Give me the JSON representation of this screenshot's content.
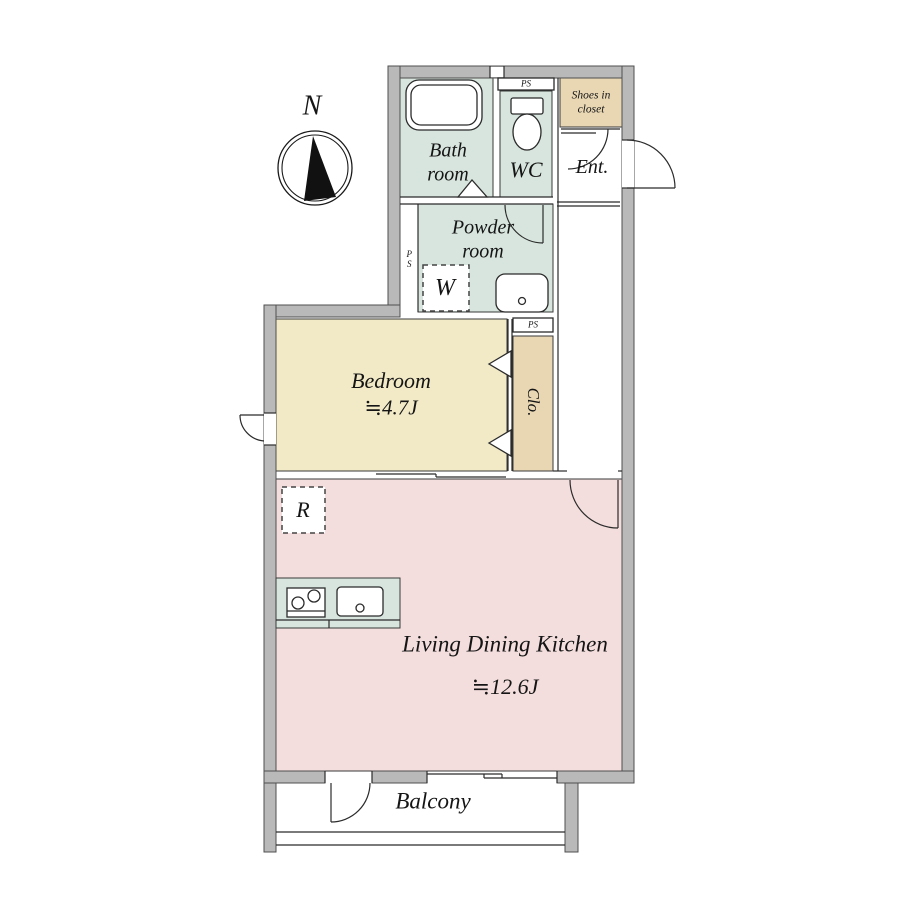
{
  "compass": {
    "north_label": "N"
  },
  "rooms": {
    "bathroom": {
      "label": "Bath room"
    },
    "wc": {
      "label": "WC"
    },
    "entrance": {
      "label": "Ent."
    },
    "shoes_closet": {
      "label": "Shoes in closet"
    },
    "powder_room": {
      "label": "Powder room"
    },
    "bedroom": {
      "label": "Bedroom",
      "area": "≒4.7J"
    },
    "closet": {
      "label": "Clo."
    },
    "ldk": {
      "label": "Living Dining Kitchen",
      "area": "≒12.6J"
    },
    "balcony": {
      "label": "Balcony"
    }
  },
  "fixtures": {
    "washing_machine": {
      "label": "W"
    },
    "refrigerator": {
      "label": "R"
    }
  },
  "utility": {
    "pipe_space_top": {
      "label": "PS"
    },
    "pipe_space_left": {
      "label": "PS"
    },
    "pipe_space_mid": {
      "label": "PS"
    }
  },
  "colors": {
    "wet_area_mint": "#d7e5de",
    "bedroom_cream": "#f2eac6",
    "ldk_pink": "#f4dedd",
    "storage_tan": "#e9d7b4",
    "wall_gray": "#b9b9b9",
    "line": "#2b2b2b"
  }
}
